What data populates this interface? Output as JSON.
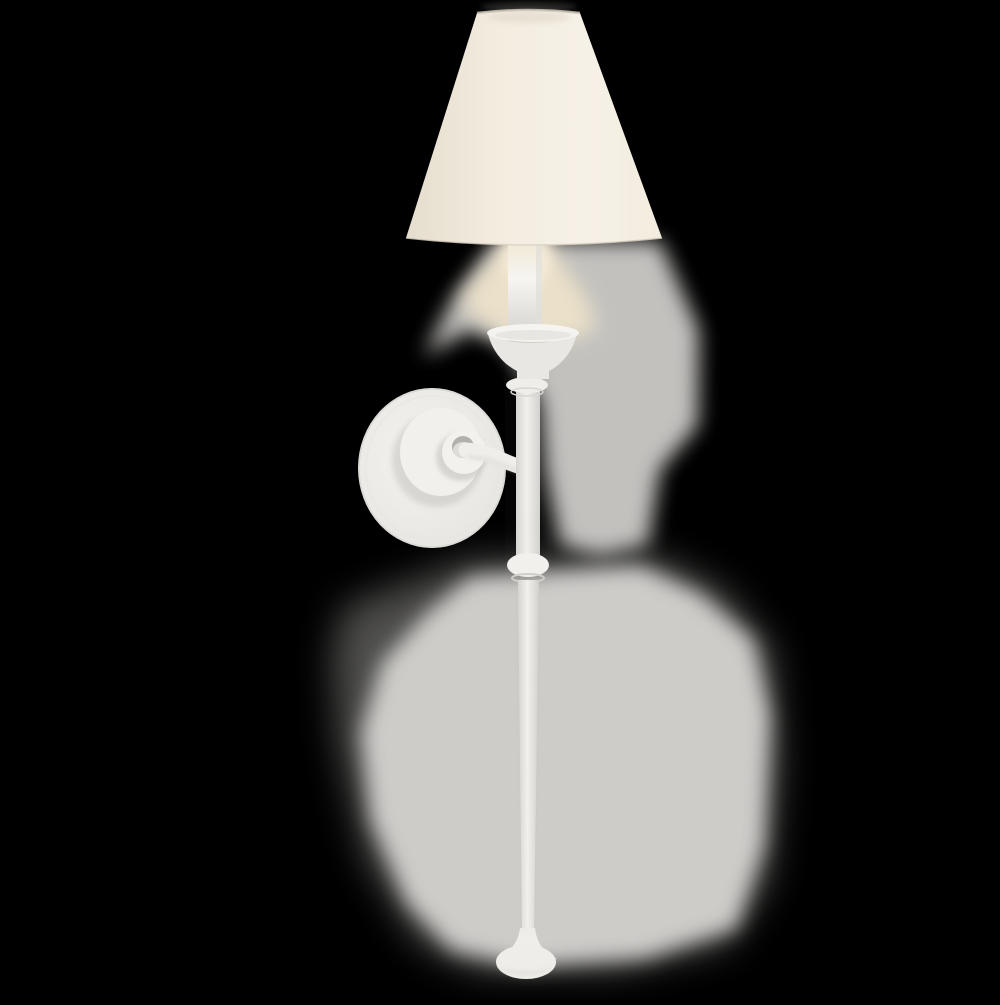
{
  "image": {
    "type": "product-photograph",
    "background": "black",
    "subject": "Plaster-white tail wall sconce with cream linen cone shade",
    "alt": "White plaster single-arm tail wall sconce with a cream conical linen shade over a lit candle sleeve, flared bobeche, round layered wall plate, and a long tapering drop stem with a knob that ends in a small textured finial foot, photographed against a black background with a soft gray halo of studio backdrop around the fixture"
  },
  "parts": {
    "shade": "conical linen shade",
    "candle": "candle sleeve with warm glow",
    "bobeche": "flared bobeche cup",
    "wall_plate": "round layered wall plate with center hub",
    "arm": "curved mounting arm",
    "stem": "long tapering tail stem with mid knob",
    "finial": "textured bun finial foot"
  },
  "colors": {
    "background": "#000000",
    "halo_gray": "#cdccc9",
    "halo_dim": "#8f8e8b",
    "shade_edge": "#e5ddcd",
    "shade_cream": "#f3ecdf",
    "shade_bright": "#f6f1e7",
    "shade_rim": "#c9c3b6",
    "glow_warm": "#f0e4ca",
    "candle_warm": "#f1e6d1",
    "candle_white": "#f6f5f2",
    "fixture_white": "#f3f2ef",
    "fixture_shadow": "#d8d6d2",
    "hub_shadow": "#b2b1ad"
  }
}
